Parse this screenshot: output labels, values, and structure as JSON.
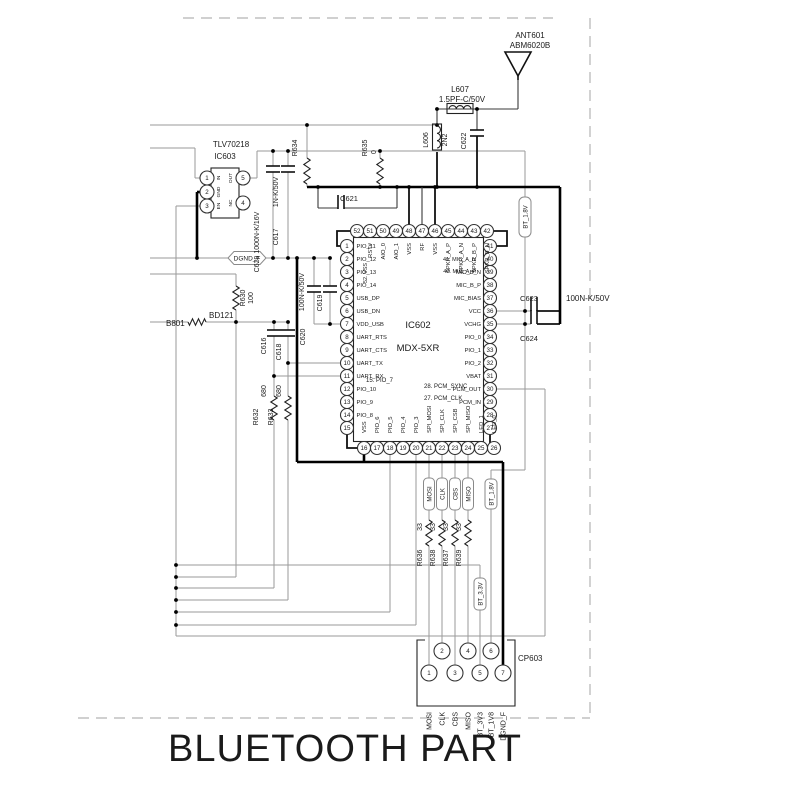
{
  "title": "BLUETOOTH PART",
  "antenna": {
    "ref": "ANT601",
    "part": "ABM6020B"
  },
  "rf": {
    "l607": {
      "ref": "L607",
      "value": "1.5PF-C/50V"
    },
    "l606": {
      "ref": "L606",
      "value": "2N2"
    },
    "c622": {
      "ref": "C622"
    },
    "c621": {
      "ref": "C621"
    },
    "r635": {
      "ref": "R635",
      "value": "0"
    },
    "r634": {
      "ref": "R634"
    }
  },
  "regulator": {
    "part": "TLV70218",
    "ref": "IC603",
    "pins": [
      {
        "num": "1",
        "name": "IN"
      },
      {
        "num": "2",
        "name": "GND"
      },
      {
        "num": "3",
        "name": "EN"
      },
      {
        "num": "4",
        "name": "NC"
      },
      {
        "num": "5",
        "name": "OUT"
      }
    ]
  },
  "left_parts": {
    "c629": {
      "label": "C629 1000N-K/16V"
    },
    "c617": {
      "ref": "C617",
      "value": "1N-K/50V"
    },
    "r630": {
      "ref": "R630",
      "value": "100"
    },
    "b801": {
      "ref": "B801",
      "part": "BD121"
    },
    "c620": {
      "ref": "C620"
    },
    "c619": {
      "ref": "C619"
    },
    "caps_value": "100N-K/50V",
    "c616": {
      "ref": "C616"
    },
    "c618": {
      "ref": "C618"
    },
    "r632": {
      "ref": "R632",
      "value": "680"
    },
    "r633": {
      "ref": "R633",
      "value": "680"
    }
  },
  "flags": {
    "dgnd_f": "DGND_F",
    "bt18_top": "BT_1.8V",
    "bt18_bottom": "BT_1.8V",
    "bt33": "BT_3.3V",
    "mosi": "MOSI",
    "clk": "CLK",
    "cbs": "CBS",
    "miso": "MISO"
  },
  "ic602": {
    "ref": "IC602",
    "part": "MDX-5XR",
    "top_pins": [
      {
        "num": "52",
        "name": ""
      },
      {
        "num": "51",
        "name": "RST#"
      },
      {
        "num": "50",
        "name": "AIO_0"
      },
      {
        "num": "49",
        "name": "AIO_1"
      },
      {
        "num": "48",
        "name": "VSS"
      },
      {
        "num": "47",
        "name": "RF"
      },
      {
        "num": "46",
        "name": "VSS"
      },
      {
        "num": "45",
        "name": "SPKR_A_P"
      },
      {
        "num": "44",
        "name": "SPKR_A_N"
      },
      {
        "num": "43",
        "name": "SPKR_B_P"
      },
      {
        "num": "42",
        "name": "SPKR_B_N"
      }
    ],
    "left_pins": [
      {
        "num": "1",
        "name": "PIO_11"
      },
      {
        "num": "2",
        "name": "PIO_12"
      },
      {
        "num": "3",
        "name": "PIO_13"
      },
      {
        "num": "4",
        "name": "PIO_14"
      },
      {
        "num": "5",
        "name": "USB_DP"
      },
      {
        "num": "6",
        "name": "USB_DN"
      },
      {
        "num": "7",
        "name": "VDD_USB"
      },
      {
        "num": "8",
        "name": "UART_RTS"
      },
      {
        "num": "9",
        "name": "UART_CTS"
      },
      {
        "num": "10",
        "name": "UART_TX"
      },
      {
        "num": "11",
        "name": "UART_RX"
      },
      {
        "num": "12",
        "name": "PIO_10"
      },
      {
        "num": "13",
        "name": "PIO_9"
      },
      {
        "num": "14",
        "name": "PIO_8"
      },
      {
        "num": "15",
        "name": ""
      }
    ],
    "right_pins": [
      {
        "num": "41",
        "name": ""
      },
      {
        "num": "40",
        "name": ""
      },
      {
        "num": "39",
        "name": "MIC_B_N"
      },
      {
        "num": "38",
        "name": "MIC_B_P"
      },
      {
        "num": "37",
        "name": "MIC_BIAS"
      },
      {
        "num": "36",
        "name": "VCC"
      },
      {
        "num": "35",
        "name": "VCHG"
      },
      {
        "num": "34",
        "name": "PIO_0"
      },
      {
        "num": "33",
        "name": "PIO_1"
      },
      {
        "num": "32",
        "name": "PIO_2"
      },
      {
        "num": "31",
        "name": "VBAT"
      },
      {
        "num": "30",
        "name": "PCM_OUT"
      },
      {
        "num": "29",
        "name": "PCM_IN"
      },
      {
        "num": "28",
        "name": ""
      },
      {
        "num": "27",
        "name": ""
      }
    ],
    "bottom_pins": [
      {
        "num": "16",
        "name": "VSS"
      },
      {
        "num": "17",
        "name": "PIO_6"
      },
      {
        "num": "18",
        "name": "PIO_5"
      },
      {
        "num": "19",
        "name": "PIO_4"
      },
      {
        "num": "20",
        "name": "PIO_3"
      },
      {
        "num": "21",
        "name": "SPI_MOSI"
      },
      {
        "num": "22",
        "name": "SPI_CLK"
      },
      {
        "num": "23",
        "name": "SPI_CSB"
      },
      {
        "num": "24",
        "name": "SPI_MISO"
      },
      {
        "num": "25",
        "name": "LED_1"
      },
      {
        "num": "26",
        "name": "LED_0"
      }
    ],
    "notes": {
      "n52": "52. VSS",
      "n41": "41. MIC_A_N",
      "n40": "40. MIC_A_P",
      "n15": "15. PIO_7",
      "n28": "28. PCM_SYNC",
      "n27": "27. PCM_CLK"
    }
  },
  "right_caps": {
    "c623": {
      "ref": "C623"
    },
    "c624": {
      "ref": "C624"
    },
    "value": "100N-K/50V"
  },
  "spi_resistors": [
    {
      "ref": "R636",
      "value": "33"
    },
    {
      "ref": "R638",
      "value": "33"
    },
    {
      "ref": "R637",
      "value": "33"
    },
    {
      "ref": "R639",
      "value": "33"
    }
  ],
  "connector": {
    "ref": "CP603",
    "pins": [
      {
        "num": "1",
        "label": "MOSI"
      },
      {
        "num": "2",
        "label": "CLK"
      },
      {
        "num": "3",
        "label": "CBS"
      },
      {
        "num": "4",
        "label": "MISO"
      },
      {
        "num": "5",
        "label": "BT_3V3"
      },
      {
        "num": "6",
        "label": "BT_1V8"
      },
      {
        "num": "7",
        "label": "DGND_F"
      }
    ]
  }
}
